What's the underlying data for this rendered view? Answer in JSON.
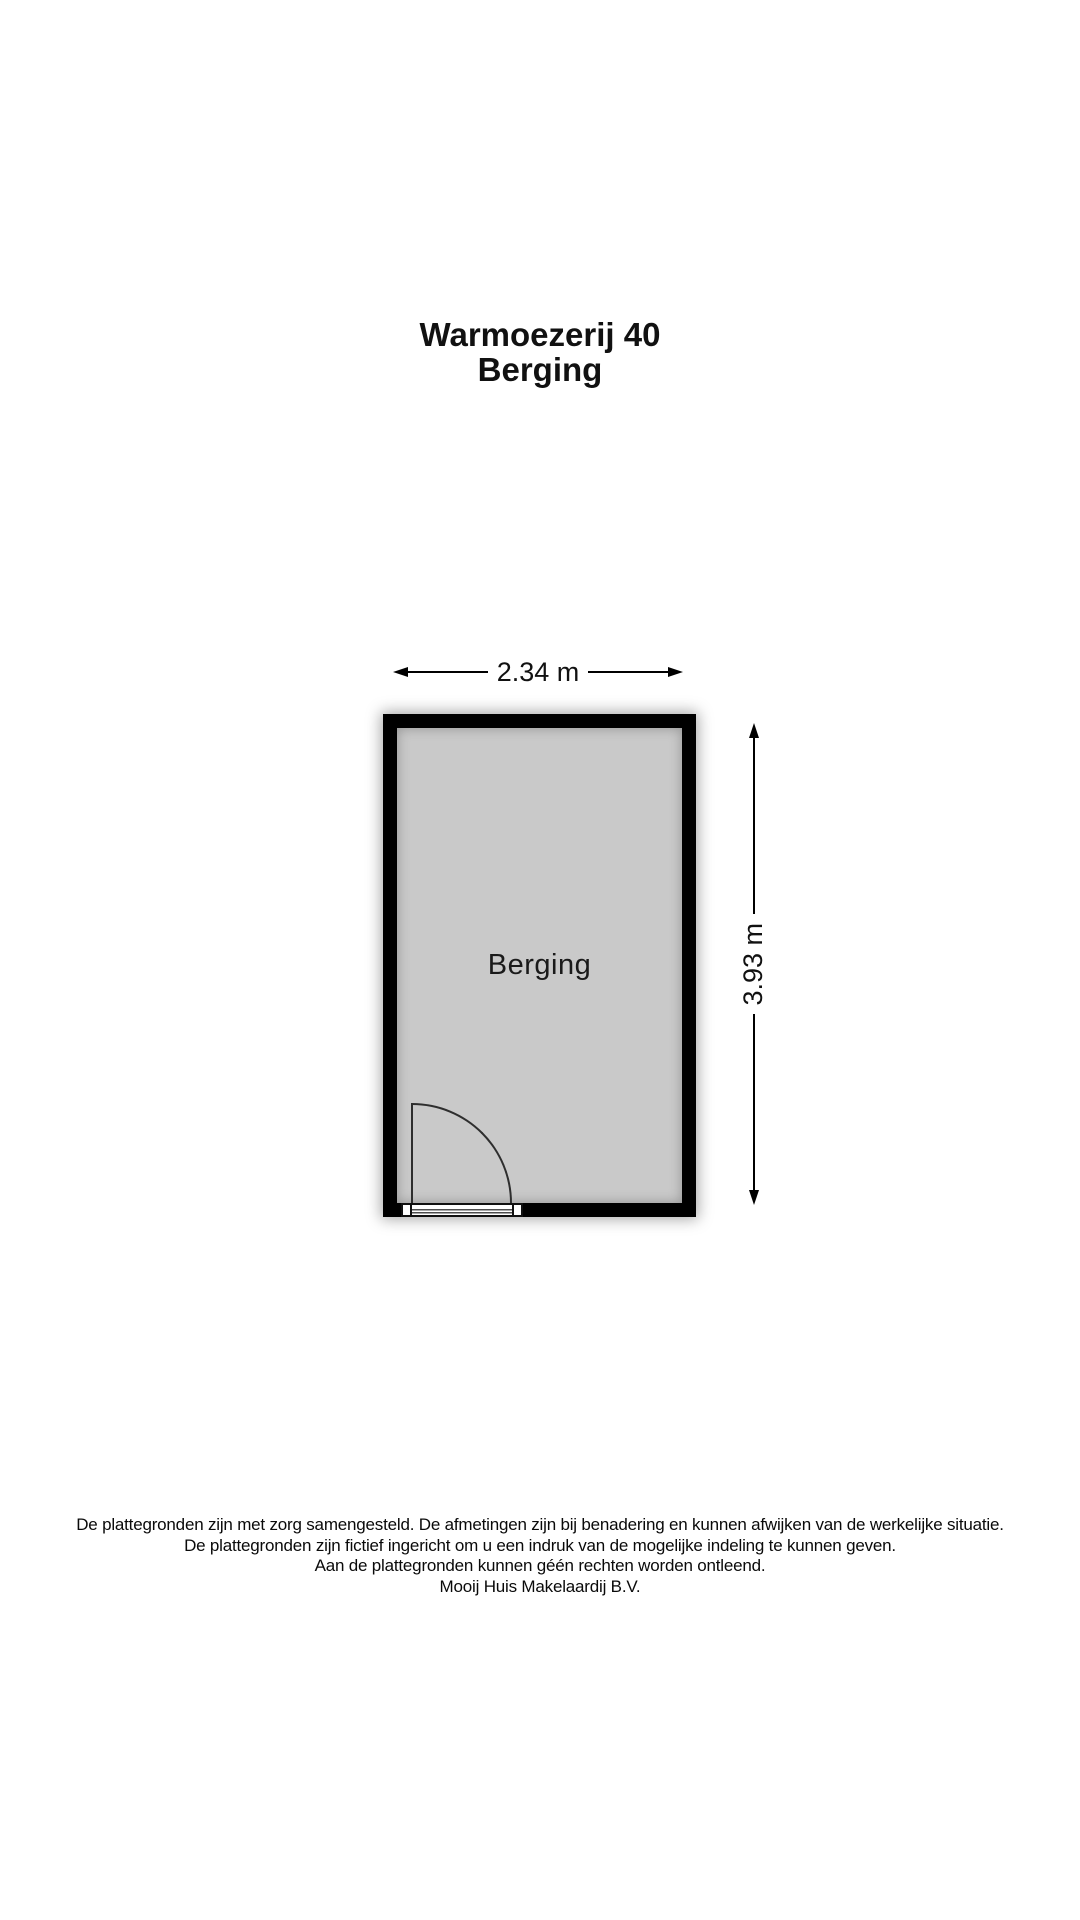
{
  "header": {
    "address": "Warmoezerij 40",
    "floor_name": "Berging"
  },
  "floorplan": {
    "room_label": "Berging",
    "width_label": "2.34 m",
    "height_label": "3.93 m",
    "colors": {
      "wall": "#000000",
      "floor": "#c9c9c9",
      "background": "#ffffff",
      "line": "#2e2e2e"
    },
    "icons": {
      "arrowhead_left": "filled-triangle-left",
      "arrowhead_right": "filled-triangle-right",
      "arrowhead_up": "filled-triangle-up",
      "arrowhead_down": "filled-triangle-down",
      "door_swing_arc": "quarter-circle-arc"
    }
  },
  "footer": {
    "lines": [
      "De plattegronden zijn met zorg samengesteld. De afmetingen zijn bij benadering en kunnen afwijken van de werkelijke situatie.",
      "De plattegronden zijn fictief ingericht om u een indruk van de mogelijke indeling te kunnen geven.",
      "Aan de plattegronden kunnen géén rechten worden ontleend.",
      "Mooij Huis Makelaardij B.V."
    ]
  }
}
